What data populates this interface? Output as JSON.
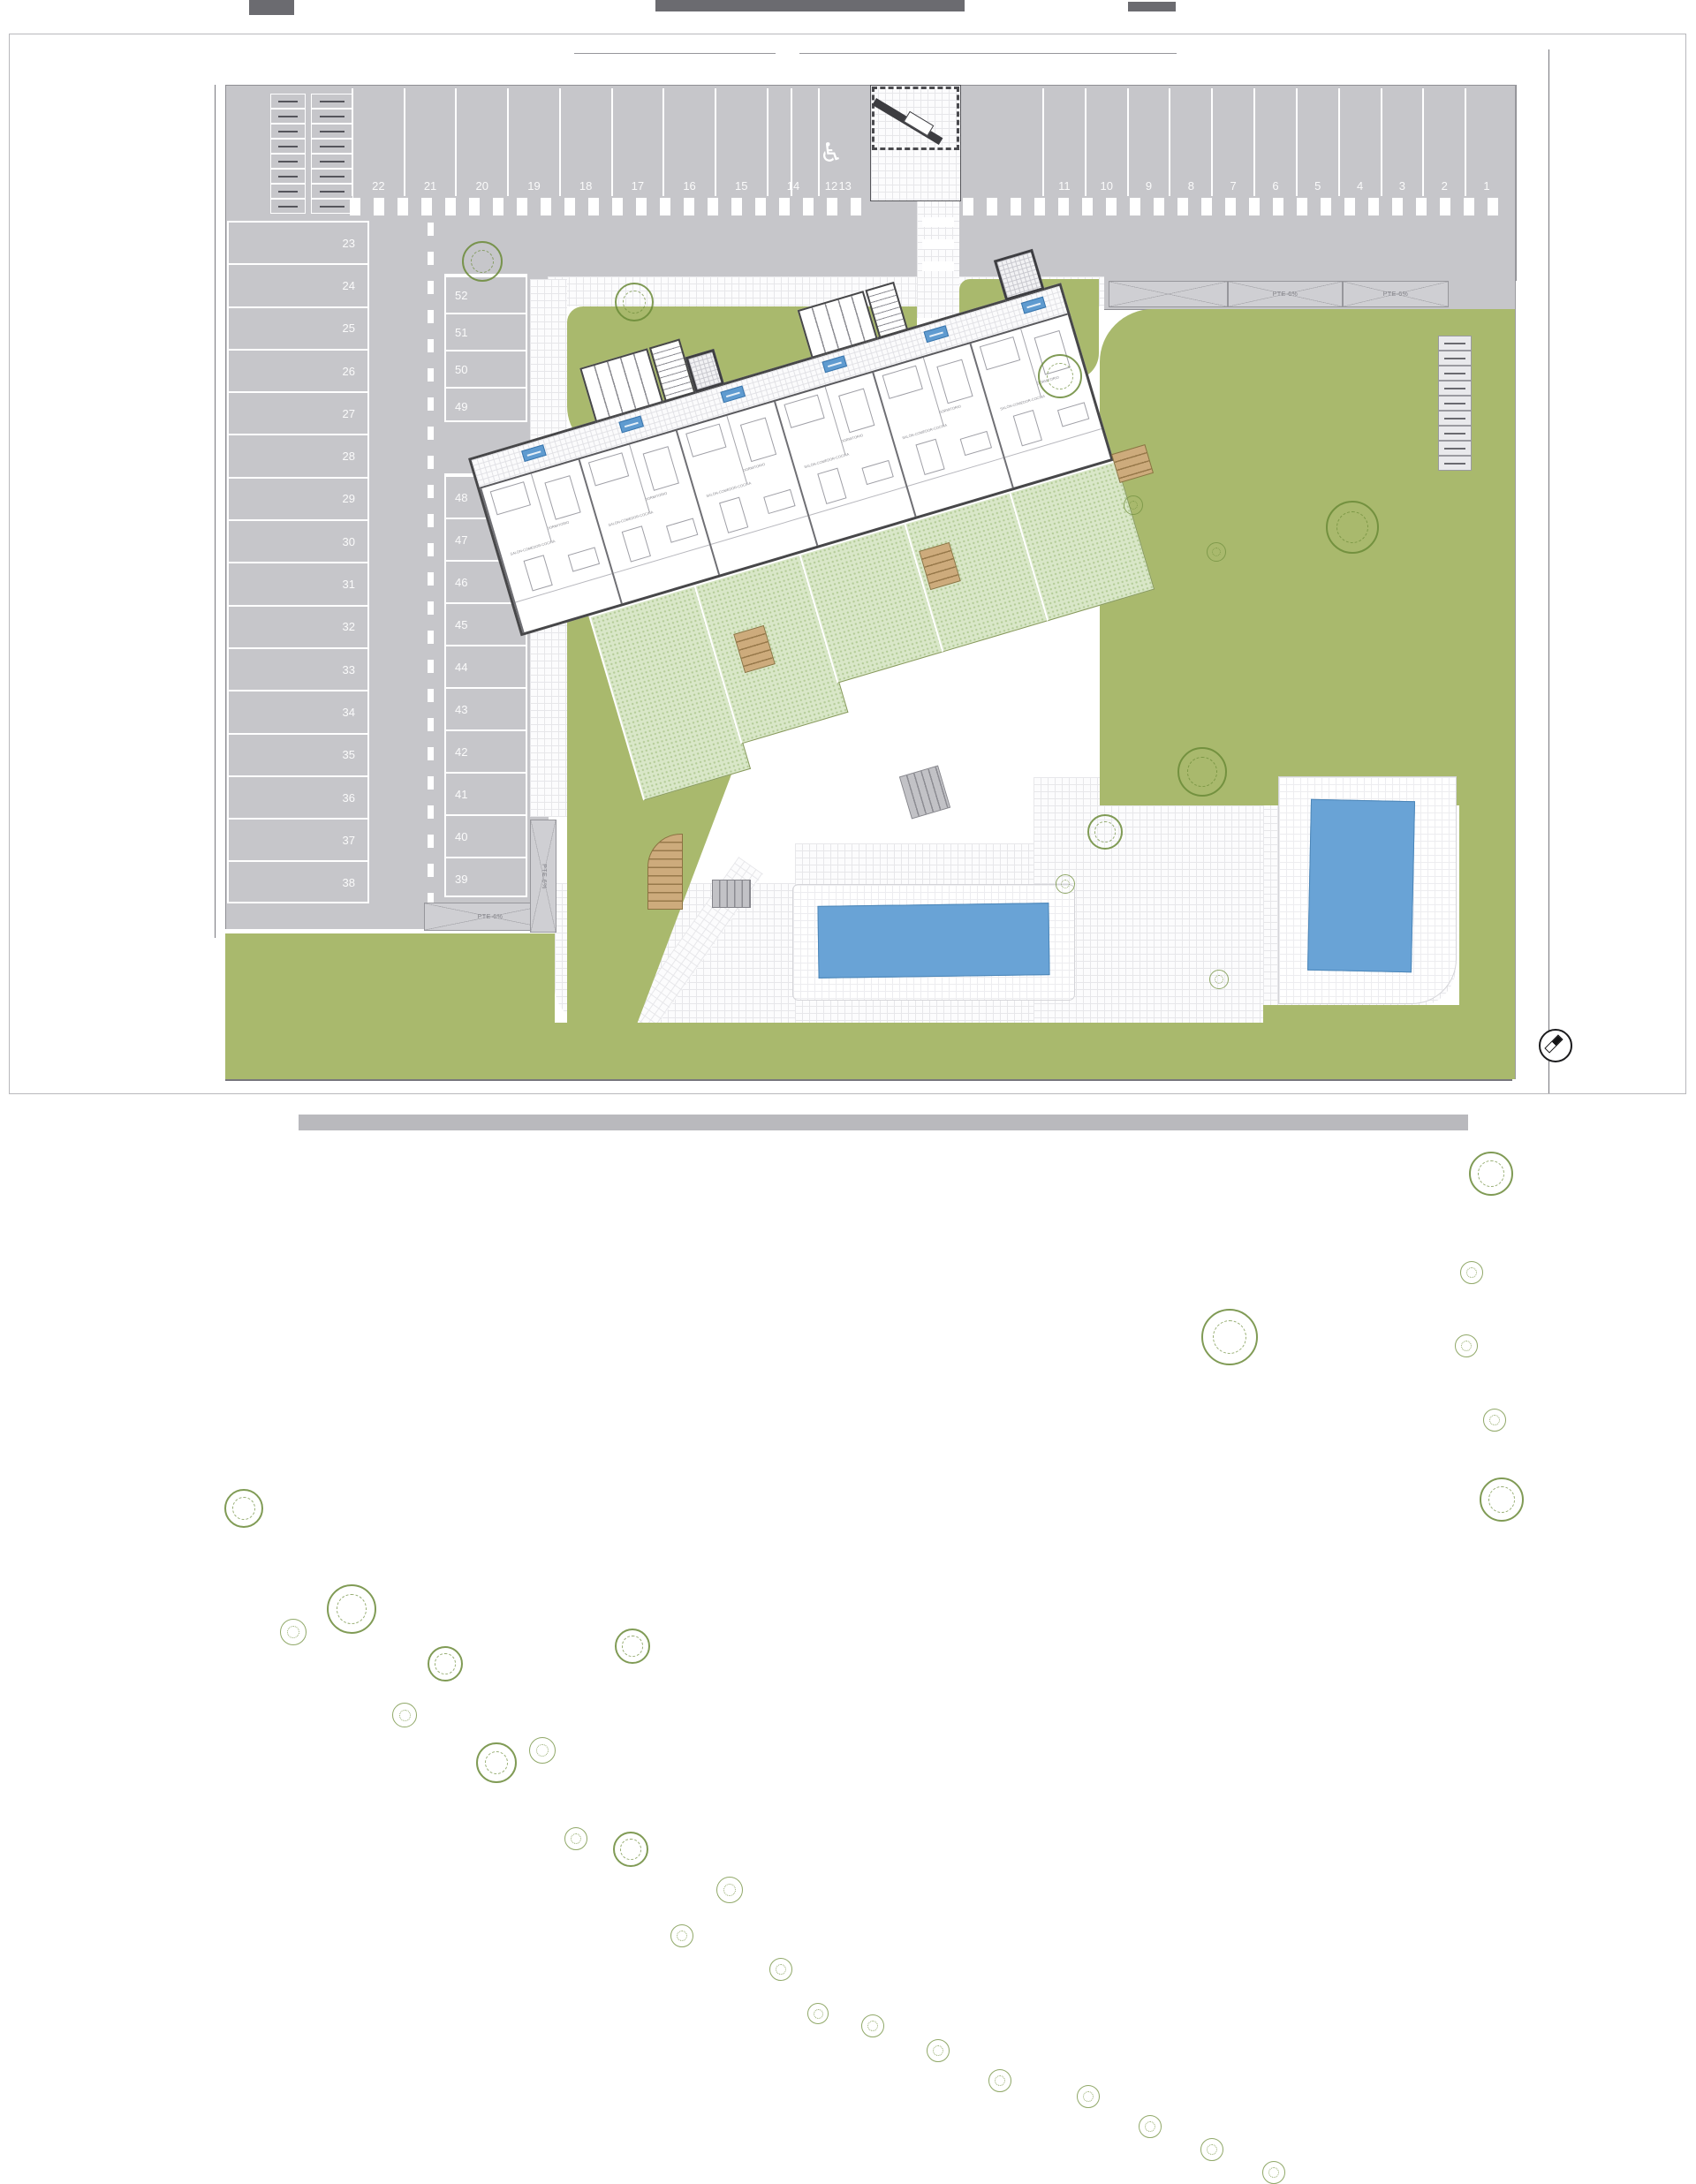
{
  "plan": {
    "parking": {
      "top_left_spaces": [
        "22",
        "21",
        "20",
        "19",
        "18",
        "17",
        "16",
        "15",
        "14",
        "13"
      ],
      "handicap_space": "12",
      "top_right_spaces": [
        "11",
        "10",
        "9",
        "8",
        "7",
        "6",
        "5",
        "4",
        "3",
        "2",
        "1"
      ],
      "left_column_spaces": [
        "23",
        "24",
        "25",
        "26",
        "27",
        "28",
        "29",
        "30",
        "31",
        "32",
        "33",
        "34",
        "35",
        "36",
        "37",
        "38"
      ],
      "middle_column_upper": [
        "52",
        "51",
        "50",
        "49"
      ],
      "middle_column_lower": [
        "48",
        "47",
        "46",
        "45",
        "44",
        "43",
        "42",
        "41",
        "40",
        "39"
      ]
    },
    "labels": {
      "ramp": "PTE 6%"
    },
    "icons": {
      "handicap": "♿"
    },
    "building": {
      "units": [
        {
          "living": "SALÓN-COMEDOR-COCINA",
          "bedroom": "DORMITORIO"
        },
        {
          "living": "SALÓN-COMEDOR-COCINA",
          "bedroom": "DORMITORIO"
        },
        {
          "living": "SALÓN-COMEDOR-COCINA",
          "bedroom": "DORMITORIO"
        },
        {
          "living": "SALÓN-COMEDOR-COCINA",
          "bedroom": "DORMITORIO"
        },
        {
          "living": "SALÓN-COMEDOR-COCINA",
          "bedroom": "DORMITORIO"
        },
        {
          "living": "SALÓN-COMEDOR-COCINA",
          "bedroom": "DORMITORIO"
        }
      ]
    },
    "colors": {
      "grass": "#a9b96d",
      "garden": "#d9e7c8",
      "pool": "#69a3d6",
      "asphalt": "#c6c6ca",
      "badge": "#5f9bd0"
    }
  }
}
